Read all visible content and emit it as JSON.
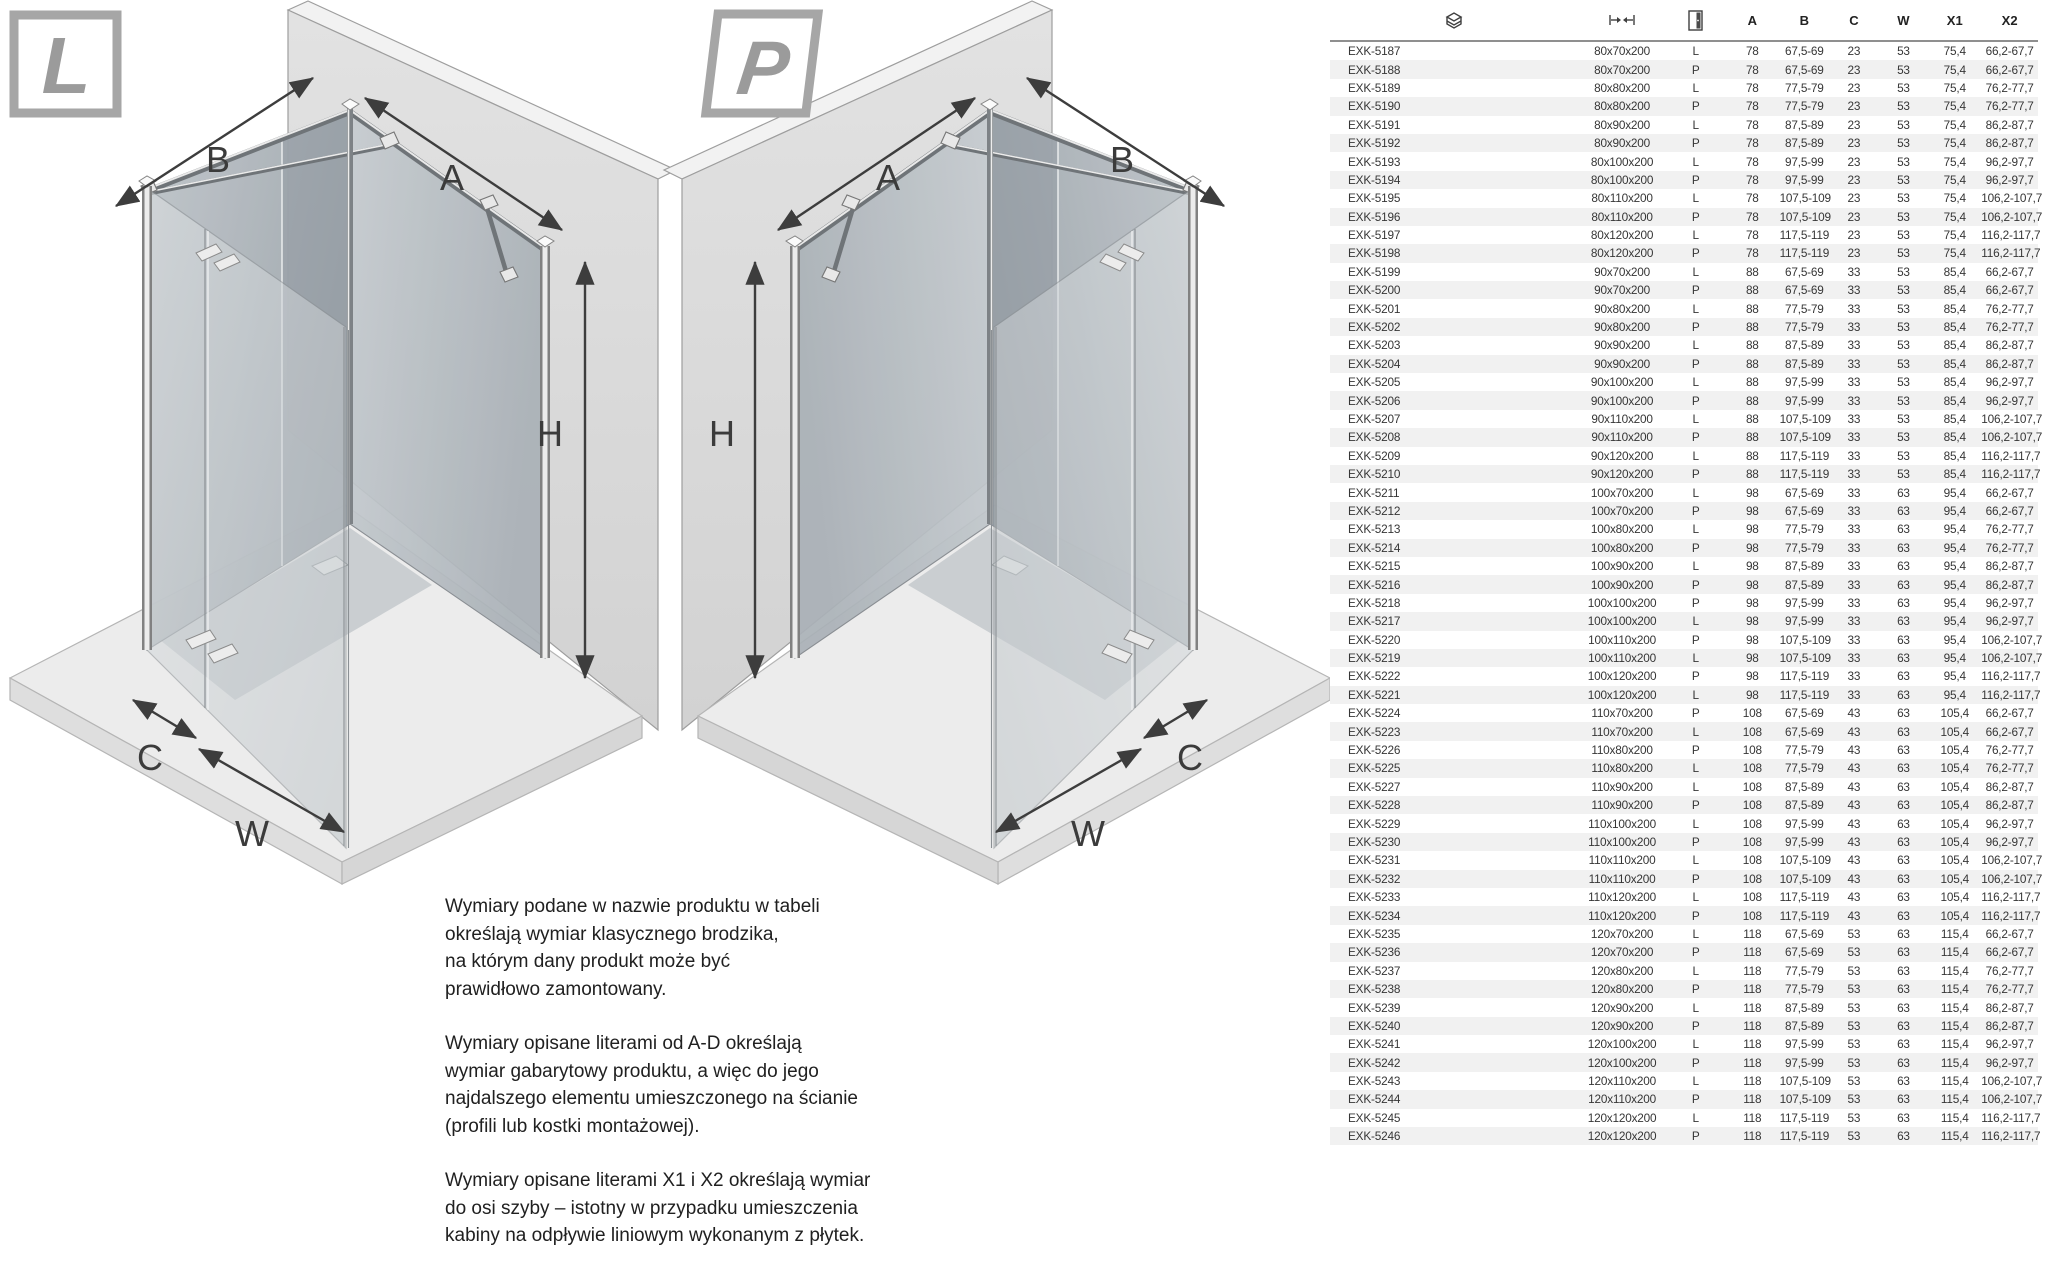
{
  "diagrams": {
    "left": {
      "badge": "L",
      "dims": {
        "A": "A",
        "B": "B",
        "C": "C",
        "H": "H",
        "W": "W"
      }
    },
    "right": {
      "badge": "P",
      "dims": {
        "A": "A",
        "B": "B",
        "C": "C",
        "H": "H",
        "W": "W"
      }
    }
  },
  "notes": {
    "p1": "Wymiary podane w nazwie produktu w tabeli\nokreślają wymiar klasycznego brodzika,\nna którym dany produkt może być\nprawidłowo zamontowany.",
    "p2": "Wymiary opisane literami od A-D określają\nwymiar gabarytowy produktu, a więc do jego\nnajdalszego elementu umieszczonego na ścianie\n(profili lub kostki montażowej).",
    "p3": "Wymiary opisane literami X1 i X2 określają wymiar\ndo osi szyby – istotny w przypadku umieszczenia\nkabiny na odpływie liniowym wykonanym z płytek."
  },
  "table": {
    "column_icons": [
      {
        "name": "tray-stack-icon"
      },
      {
        "name": "width-dimension-icon"
      },
      {
        "name": "door-leaf-icon"
      }
    ],
    "headers": [
      "A",
      "B",
      "C",
      "W",
      "X1",
      "X2"
    ],
    "rows": [
      [
        "EXK-5187",
        "80x70x200",
        "L",
        "78",
        "67,5-69",
        "23",
        "53",
        "75,4",
        "66,2-67,7"
      ],
      [
        "EXK-5188",
        "80x70x200",
        "P",
        "78",
        "67,5-69",
        "23",
        "53",
        "75,4",
        "66,2-67,7"
      ],
      [
        "EXK-5189",
        "80x80x200",
        "L",
        "78",
        "77,5-79",
        "23",
        "53",
        "75,4",
        "76,2-77,7"
      ],
      [
        "EXK-5190",
        "80x80x200",
        "P",
        "78",
        "77,5-79",
        "23",
        "53",
        "75,4",
        "76,2-77,7"
      ],
      [
        "EXK-5191",
        "80x90x200",
        "L",
        "78",
        "87,5-89",
        "23",
        "53",
        "75,4",
        "86,2-87,7"
      ],
      [
        "EXK-5192",
        "80x90x200",
        "P",
        "78",
        "87,5-89",
        "23",
        "53",
        "75,4",
        "86,2-87,7"
      ],
      [
        "EXK-5193",
        "80x100x200",
        "L",
        "78",
        "97,5-99",
        "23",
        "53",
        "75,4",
        "96,2-97,7"
      ],
      [
        "EXK-5194",
        "80x100x200",
        "P",
        "78",
        "97,5-99",
        "23",
        "53",
        "75,4",
        "96,2-97,7"
      ],
      [
        "EXK-5195",
        "80x110x200",
        "L",
        "78",
        "107,5-109",
        "23",
        "53",
        "75,4",
        "106,2-107,7"
      ],
      [
        "EXK-5196",
        "80x110x200",
        "P",
        "78",
        "107,5-109",
        "23",
        "53",
        "75,4",
        "106,2-107,7"
      ],
      [
        "EXK-5197",
        "80x120x200",
        "L",
        "78",
        "117,5-119",
        "23",
        "53",
        "75,4",
        "116,2-117,7"
      ],
      [
        "EXK-5198",
        "80x120x200",
        "P",
        "78",
        "117,5-119",
        "23",
        "53",
        "75,4",
        "116,2-117,7"
      ],
      [
        "EXK-5199",
        "90x70x200",
        "L",
        "88",
        "67,5-69",
        "33",
        "53",
        "85,4",
        "66,2-67,7"
      ],
      [
        "EXK-5200",
        "90x70x200",
        "P",
        "88",
        "67,5-69",
        "33",
        "53",
        "85,4",
        "66,2-67,7"
      ],
      [
        "EXK-5201",
        "90x80x200",
        "L",
        "88",
        "77,5-79",
        "33",
        "53",
        "85,4",
        "76,2-77,7"
      ],
      [
        "EXK-5202",
        "90x80x200",
        "P",
        "88",
        "77,5-79",
        "33",
        "53",
        "85,4",
        "76,2-77,7"
      ],
      [
        "EXK-5203",
        "90x90x200",
        "L",
        "88",
        "87,5-89",
        "33",
        "53",
        "85,4",
        "86,2-87,7"
      ],
      [
        "EXK-5204",
        "90x90x200",
        "P",
        "88",
        "87,5-89",
        "33",
        "53",
        "85,4",
        "86,2-87,7"
      ],
      [
        "EXK-5205",
        "90x100x200",
        "L",
        "88",
        "97,5-99",
        "33",
        "53",
        "85,4",
        "96,2-97,7"
      ],
      [
        "EXK-5206",
        "90x100x200",
        "P",
        "88",
        "97,5-99",
        "33",
        "53",
        "85,4",
        "96,2-97,7"
      ],
      [
        "EXK-5207",
        "90x110x200",
        "L",
        "88",
        "107,5-109",
        "33",
        "53",
        "85,4",
        "106,2-107,7"
      ],
      [
        "EXK-5208",
        "90x110x200",
        "P",
        "88",
        "107,5-109",
        "33",
        "53",
        "85,4",
        "106,2-107,7"
      ],
      [
        "EXK-5209",
        "90x120x200",
        "L",
        "88",
        "117,5-119",
        "33",
        "53",
        "85,4",
        "116,2-117,7"
      ],
      [
        "EXK-5210",
        "90x120x200",
        "P",
        "88",
        "117,5-119",
        "33",
        "53",
        "85,4",
        "116,2-117,7"
      ],
      [
        "EXK-5211",
        "100x70x200",
        "L",
        "98",
        "67,5-69",
        "33",
        "63",
        "95,4",
        "66,2-67,7"
      ],
      [
        "EXK-5212",
        "100x70x200",
        "P",
        "98",
        "67,5-69",
        "33",
        "63",
        "95,4",
        "66,2-67,7"
      ],
      [
        "EXK-5213",
        "100x80x200",
        "L",
        "98",
        "77,5-79",
        "33",
        "63",
        "95,4",
        "76,2-77,7"
      ],
      [
        "EXK-5214",
        "100x80x200",
        "P",
        "98",
        "77,5-79",
        "33",
        "63",
        "95,4",
        "76,2-77,7"
      ],
      [
        "EXK-5215",
        "100x90x200",
        "L",
        "98",
        "87,5-89",
        "33",
        "63",
        "95,4",
        "86,2-87,7"
      ],
      [
        "EXK-5216",
        "100x90x200",
        "P",
        "98",
        "87,5-89",
        "33",
        "63",
        "95,4",
        "86,2-87,7"
      ],
      [
        "EXK-5218",
        "100x100x200",
        "P",
        "98",
        "97,5-99",
        "33",
        "63",
        "95,4",
        "96,2-97,7"
      ],
      [
        "EXK-5217",
        "100x100x200",
        "L",
        "98",
        "97,5-99",
        "33",
        "63",
        "95,4",
        "96,2-97,7"
      ],
      [
        "EXK-5220",
        "100x110x200",
        "P",
        "98",
        "107,5-109",
        "33",
        "63",
        "95,4",
        "106,2-107,7"
      ],
      [
        "EXK-5219",
        "100x110x200",
        "L",
        "98",
        "107,5-109",
        "33",
        "63",
        "95,4",
        "106,2-107,7"
      ],
      [
        "EXK-5222",
        "100x120x200",
        "P",
        "98",
        "117,5-119",
        "33",
        "63",
        "95,4",
        "116,2-117,7"
      ],
      [
        "EXK-5221",
        "100x120x200",
        "L",
        "98",
        "117,5-119",
        "33",
        "63",
        "95,4",
        "116,2-117,7"
      ],
      [
        "EXK-5224",
        "110x70x200",
        "P",
        "108",
        "67,5-69",
        "43",
        "63",
        "105,4",
        "66,2-67,7"
      ],
      [
        "EXK-5223",
        "110x70x200",
        "L",
        "108",
        "67,5-69",
        "43",
        "63",
        "105,4",
        "66,2-67,7"
      ],
      [
        "EXK-5226",
        "110x80x200",
        "P",
        "108",
        "77,5-79",
        "43",
        "63",
        "105,4",
        "76,2-77,7"
      ],
      [
        "EXK-5225",
        "110x80x200",
        "L",
        "108",
        "77,5-79",
        "43",
        "63",
        "105,4",
        "76,2-77,7"
      ],
      [
        "EXK-5227",
        "110x90x200",
        "L",
        "108",
        "87,5-89",
        "43",
        "63",
        "105,4",
        "86,2-87,7"
      ],
      [
        "EXK-5228",
        "110x90x200",
        "P",
        "108",
        "87,5-89",
        "43",
        "63",
        "105,4",
        "86,2-87,7"
      ],
      [
        "EXK-5229",
        "110x100x200",
        "L",
        "108",
        "97,5-99",
        "43",
        "63",
        "105,4",
        "96,2-97,7"
      ],
      [
        "EXK-5230",
        "110x100x200",
        "P",
        "108",
        "97,5-99",
        "43",
        "63",
        "105,4",
        "96,2-97,7"
      ],
      [
        "EXK-5231",
        "110x110x200",
        "L",
        "108",
        "107,5-109",
        "43",
        "63",
        "105,4",
        "106,2-107,7"
      ],
      [
        "EXK-5232",
        "110x110x200",
        "P",
        "108",
        "107,5-109",
        "43",
        "63",
        "105,4",
        "106,2-107,7"
      ],
      [
        "EXK-5233",
        "110x120x200",
        "L",
        "108",
        "117,5-119",
        "43",
        "63",
        "105,4",
        "116,2-117,7"
      ],
      [
        "EXK-5234",
        "110x120x200",
        "P",
        "108",
        "117,5-119",
        "43",
        "63",
        "105,4",
        "116,2-117,7"
      ],
      [
        "EXK-5235",
        "120x70x200",
        "L",
        "118",
        "67,5-69",
        "53",
        "63",
        "115,4",
        "66,2-67,7"
      ],
      [
        "EXK-5236",
        "120x70x200",
        "P",
        "118",
        "67,5-69",
        "53",
        "63",
        "115,4",
        "66,2-67,7"
      ],
      [
        "EXK-5237",
        "120x80x200",
        "L",
        "118",
        "77,5-79",
        "53",
        "63",
        "115,4",
        "76,2-77,7"
      ],
      [
        "EXK-5238",
        "120x80x200",
        "P",
        "118",
        "77,5-79",
        "53",
        "63",
        "115,4",
        "76,2-77,7"
      ],
      [
        "EXK-5239",
        "120x90x200",
        "L",
        "118",
        "87,5-89",
        "53",
        "63",
        "115,4",
        "86,2-87,7"
      ],
      [
        "EXK-5240",
        "120x90x200",
        "P",
        "118",
        "87,5-89",
        "53",
        "63",
        "115,4",
        "86,2-87,7"
      ],
      [
        "EXK-5241",
        "120x100x200",
        "L",
        "118",
        "97,5-99",
        "53",
        "63",
        "115,4",
        "96,2-97,7"
      ],
      [
        "EXK-5242",
        "120x100x200",
        "P",
        "118",
        "97,5-99",
        "53",
        "63",
        "115,4",
        "96,2-97,7"
      ],
      [
        "EXK-5243",
        "120x110x200",
        "L",
        "118",
        "107,5-109",
        "53",
        "63",
        "115,4",
        "106,2-107,7"
      ],
      [
        "EXK-5244",
        "120x110x200",
        "P",
        "118",
        "107,5-109",
        "53",
        "63",
        "115,4",
        "106,2-107,7"
      ],
      [
        "EXK-5245",
        "120x120x200",
        "L",
        "118",
        "117,5-119",
        "53",
        "63",
        "115,4",
        "116,2-117,7"
      ],
      [
        "EXK-5246",
        "120x120x200",
        "P",
        "118",
        "117,5-119",
        "53",
        "63",
        "115,4",
        "116,2-117,7"
      ]
    ]
  },
  "colors": {
    "stripe": "#f1f1f1",
    "header_rule": "#8f8f8f",
    "table_text": "#363636",
    "dim_label": "#3b3b3b",
    "badge_letter": "#9b9b9b",
    "wall": "#d9d9d9",
    "floor": "#ececec",
    "glass_dark": "#9aa2a9",
    "glass_light": "#d8dcde"
  }
}
